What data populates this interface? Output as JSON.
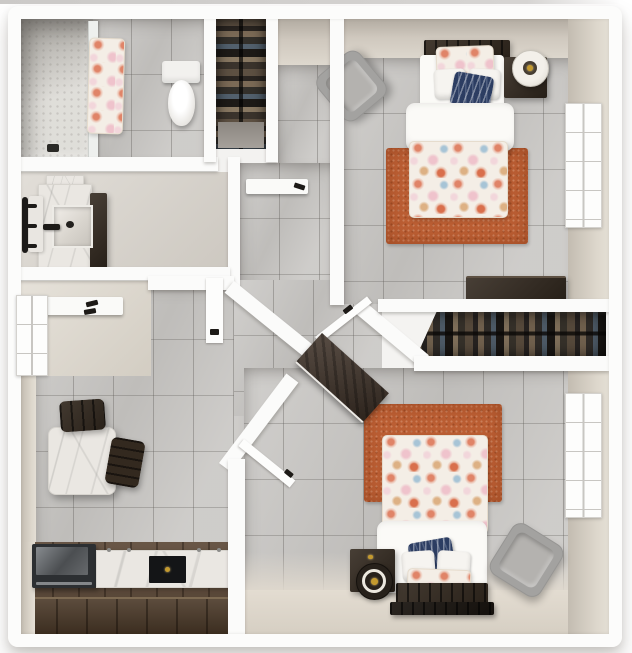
{
  "scene": {
    "kind": "3D top-down rendering of a two-bedroom apartment floor plan",
    "text_visible": "none"
  },
  "colors": {
    "page_bg": "#ffffff",
    "wall_white": "#fbfbfa",
    "tile_floor": "#c9c7c4",
    "inner_wall_beige": "#cfc8be",
    "smooth_floor": "#d8d3cb",
    "nook_floor": "#ded8cd",
    "rug_orange": "#bb5e33",
    "comforter_base": "#f4eee6",
    "floral_coral": "#e08468",
    "floral_pink": "#efc3cc",
    "floral_blue": "#a7c4d6",
    "navy_pillow": "#2c3d62",
    "white_linen": "#fbfaf7",
    "armchair_gray": "#a3a2a0",
    "dark_wood": "#33291f",
    "entry_door_wood": "#41342a",
    "kitchen_wood_floor": "#5c4837",
    "counter_front_wood": "#4a3827",
    "marble": "#eae7e2",
    "closet_interior": "#221d19",
    "appliance_dark": "#2c2f32",
    "gold_accent": "#c49a2e",
    "shower_mosaic": "#dbd9d4"
  },
  "rooms": [
    {
      "id": "bathroom",
      "items": [
        "walk-in-shower",
        "glass-shower-panel",
        "floral-shower-curtain",
        "shower-drain",
        "toilet"
      ]
    },
    {
      "id": "vanity-area",
      "items": [
        "marble-vanity",
        "vessel-sink",
        "black-faucet",
        "wall-towel-rack",
        "storage-cabinet"
      ]
    },
    {
      "id": "hall-closet",
      "items": [
        "hanging-clothes-rack",
        "shoe-shelf"
      ]
    },
    {
      "id": "hallway",
      "items": [
        "wall-shelf-with-hook",
        "open-door"
      ]
    },
    {
      "id": "coat-nook",
      "items": [
        "coat-shelf-with-hooks",
        "left-wall-window"
      ]
    },
    {
      "id": "foyer",
      "items": [
        "dark-wood-entry-door",
        "bedroom-1-door-open",
        "bedroom-2-door-open"
      ]
    },
    {
      "id": "living-dining",
      "items": [
        "marble-dining-table",
        "dark-wood-chair",
        "dark-wood-chair"
      ]
    },
    {
      "id": "kitchen",
      "items": [
        "marble-counter",
        "black-cooktop",
        "dark-appliance",
        "wood-plank-floor",
        "wood-counter-front"
      ]
    },
    {
      "id": "bedroom-1",
      "items": [
        "bed-with-floral-comforter",
        "white-duvet",
        "floral-pillow",
        "white-pillows",
        "navy-accent-pillow",
        "dark-wood-headboard",
        "nightstand",
        "drum-lamp",
        "gray-armchair",
        "orange-rug",
        "dresser",
        "window"
      ]
    },
    {
      "id": "wardrobe-closet",
      "items": [
        "hanging-clothes",
        "white-shelf"
      ]
    },
    {
      "id": "bedroom-2",
      "items": [
        "bed-with-floral-comforter",
        "white-duvet",
        "floral-pillow",
        "white-pillows",
        "navy-accent-pillow",
        "dark-wood-headboard",
        "foot-bench",
        "nightstand",
        "drum-lamp",
        "gray-armchair",
        "orange-rug",
        "window"
      ]
    }
  ]
}
